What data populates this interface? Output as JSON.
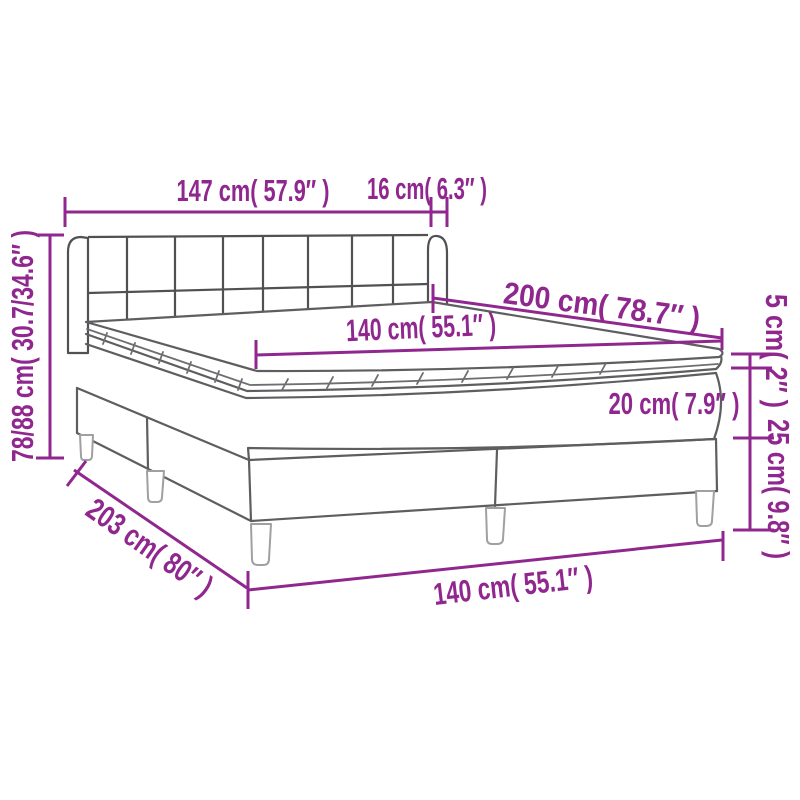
{
  "diagram": {
    "type": "product-dimension-diagram",
    "product": "box spring bed with headboard, mattress and topper",
    "accent_color": "#90278E",
    "line_color": "#5E5E61",
    "labels": {
      "headboard_width": "147 cm( 57.9″ )",
      "wing_depth": "16 cm( 6.3″ )",
      "mattress_length": "200 cm( 78.7″ )",
      "mattress_width": "140 cm( 55.1″ )",
      "total_height": "78/88 cm( 30.7/34.6″ )",
      "topper_thickness": "5 cm( 2″ )",
      "mattress_thickness": "20 cm( 7.9″ )",
      "base_height": "25 cm( 9.8″ )",
      "base_length": "203 cm( 80″ )",
      "base_width": "140 cm( 55.1″ )"
    }
  }
}
